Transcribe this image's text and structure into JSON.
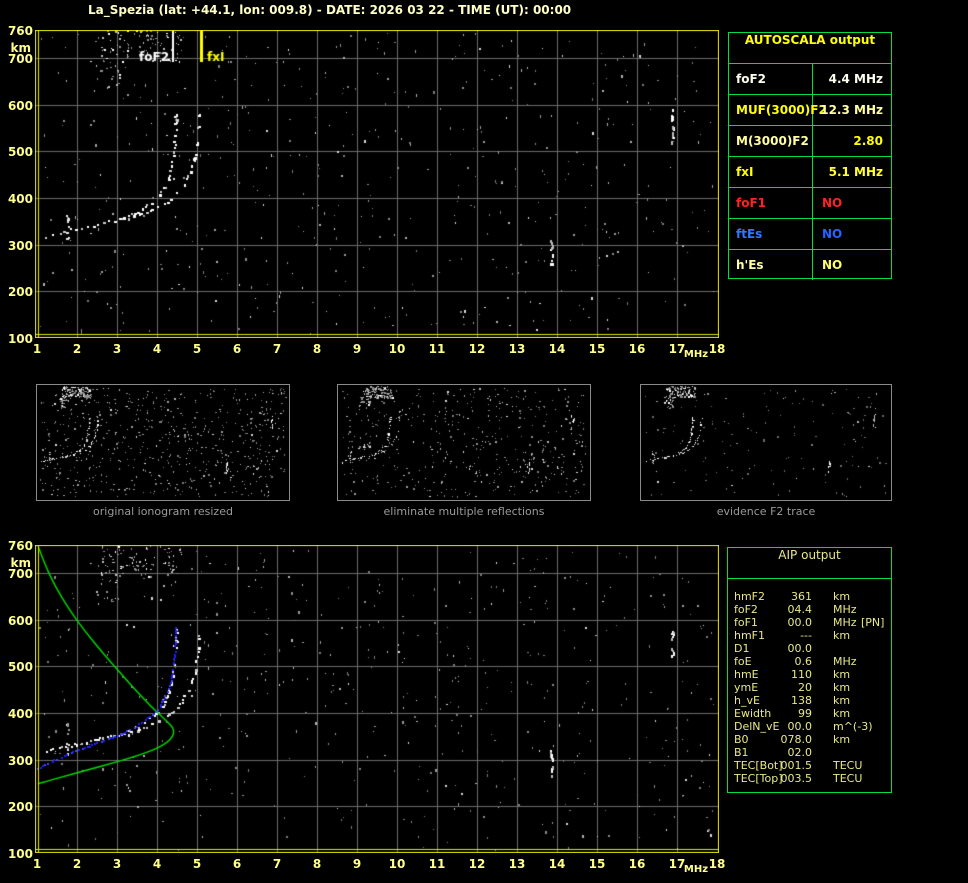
{
  "title": "La_Spezia (lat: +44.1, lon: 009.8) - DATE: 2026 03 22 - TIME (UT): 00:00",
  "colors": {
    "background": "#000000",
    "frame": "#e8e800",
    "grid": "#6b6b6b",
    "tick": "#ffff8c",
    "title": "#ffffc6",
    "table_border": "#00dd44",
    "caption": "#9a9a9a",
    "green_profile": "#00dd00",
    "blue_restored": "#1e1eff",
    "trace_white": "#ffffff",
    "aip_text": "#e8e888"
  },
  "ionogram": {
    "x_ticks": [
      1,
      2,
      3,
      4,
      5,
      6,
      7,
      8,
      9,
      10,
      11,
      12,
      13,
      14,
      15,
      16,
      17,
      18
    ],
    "x_unit": "MHz",
    "y_ticks": [
      760,
      700,
      600,
      500,
      400,
      300,
      200,
      100
    ],
    "y_unit": "km",
    "xlim": [
      1,
      18
    ],
    "ylim": [
      100,
      760
    ],
    "markers": [
      {
        "label": "foF2",
        "freq": 4.4,
        "color": "#ffffff"
      },
      {
        "label": "fxI",
        "freq": 5.1,
        "color": "#ffff00"
      }
    ]
  },
  "chart_data": {
    "type": "scatter",
    "title": "ionogram: virtual height vs frequency",
    "xlabel": "MHz",
    "ylabel": "km",
    "xlim": [
      1,
      18
    ],
    "ylim": [
      100,
      760
    ],
    "o_trace": [
      [
        1.22,
        320
      ],
      [
        1.45,
        325
      ],
      [
        1.7,
        330
      ],
      [
        2.0,
        336
      ],
      [
        2.35,
        342
      ],
      [
        2.7,
        348
      ],
      [
        3.0,
        354
      ],
      [
        3.25,
        362
      ],
      [
        3.5,
        372
      ],
      [
        3.75,
        386
      ],
      [
        3.95,
        400
      ],
      [
        4.1,
        414
      ],
      [
        4.22,
        432
      ],
      [
        4.3,
        452
      ],
      [
        4.36,
        475
      ],
      [
        4.4,
        500
      ],
      [
        4.43,
        528
      ],
      [
        4.45,
        558
      ],
      [
        4.46,
        588
      ]
    ],
    "x_trace": [
      [
        3.3,
        357
      ],
      [
        3.55,
        365
      ],
      [
        3.8,
        374
      ],
      [
        4.05,
        384
      ],
      [
        4.3,
        397
      ],
      [
        4.5,
        415
      ],
      [
        4.65,
        432
      ],
      [
        4.78,
        452
      ],
      [
        4.88,
        472
      ],
      [
        4.95,
        495
      ],
      [
        5.0,
        520
      ],
      [
        5.03,
        550
      ],
      [
        5.05,
        588
      ]
    ],
    "es_spike": {
      "freq": 1.75,
      "h_range": [
        312,
        380
      ],
      "count": 12
    },
    "interference": [
      {
        "freq": 13.85,
        "h_range": [
          256,
          322
        ],
        "count": 10
      },
      {
        "freq": 16.87,
        "h_range": [
          520,
          598
        ],
        "count": 11
      }
    ],
    "noise_clusters": [
      {
        "f_range": [
          2.6,
          4.6
        ],
        "h_range": [
          693,
          760
        ],
        "count": 95
      },
      {
        "f_range": [
          2.45,
          3.05
        ],
        "h_range": [
          632,
          695
        ],
        "count": 18
      }
    ],
    "background_noise_count": 520,
    "green_profile": [
      [
        1.03,
        757
      ],
      [
        1.2,
        718
      ],
      [
        1.45,
        672
      ],
      [
        1.8,
        622
      ],
      [
        2.2,
        575
      ],
      [
        2.65,
        528
      ],
      [
        3.1,
        484
      ],
      [
        3.5,
        446
      ],
      [
        3.85,
        414
      ],
      [
        4.15,
        390
      ],
      [
        4.35,
        374
      ],
      [
        4.43,
        362
      ],
      [
        4.39,
        349
      ],
      [
        4.25,
        336
      ],
      [
        3.95,
        322
      ],
      [
        3.5,
        308
      ],
      [
        2.95,
        294
      ],
      [
        2.35,
        280
      ],
      [
        1.75,
        266
      ],
      [
        1.25,
        254
      ],
      [
        1.02,
        248
      ]
    ],
    "blue_restored": [
      [
        1.02,
        283
      ],
      [
        1.3,
        295
      ],
      [
        1.6,
        307
      ],
      [
        1.95,
        320
      ],
      [
        2.3,
        331
      ],
      [
        2.65,
        342
      ],
      [
        3.0,
        353
      ],
      [
        3.3,
        365
      ],
      [
        3.6,
        380
      ],
      [
        3.85,
        397
      ],
      [
        4.05,
        415
      ],
      [
        4.2,
        437
      ],
      [
        4.3,
        460
      ],
      [
        4.37,
        487
      ],
      [
        4.42,
        517
      ],
      [
        4.45,
        550
      ],
      [
        4.46,
        590
      ]
    ]
  },
  "panels": [
    {
      "caption": "original ionogram resized",
      "noise_count": 620
    },
    {
      "caption": "eliminate multiple reflections",
      "noise_count": 470
    },
    {
      "caption": "evidence F2 trace",
      "noise_count": 150
    }
  ],
  "autoscala": {
    "header": "AUTOSCALA output",
    "rows": [
      {
        "label": "foF2",
        "value": "4.4 MHz",
        "label_color": "#fffff0",
        "value_color": "#fffff0"
      },
      {
        "label": "MUF(3000)F2",
        "value": "12.3 MHz",
        "label_color": "#ffff00",
        "value_color": "#ffffa0"
      },
      {
        "label": "M(3000)F2",
        "value": "2.80",
        "label_color": "#ffffa0",
        "value_color": "#ffff00"
      },
      {
        "label": "fxI",
        "value": "5.1 MHz",
        "label_color": "#ffff00",
        "value_color": "#ffff33"
      },
      {
        "label": "foF1",
        "value": "NO",
        "label_color": "#ff2222",
        "value_color": "#ff2222"
      },
      {
        "label": "ftEs",
        "value": "NO",
        "label_color": "#3377ff",
        "value_color": "#2266ff"
      },
      {
        "label": "h'Es",
        "value": "NO",
        "label_color": "#ffffa0",
        "value_color": "#ffff66"
      }
    ]
  },
  "aip": {
    "header": "AIP output",
    "rows": [
      {
        "label": "hmF2",
        "value": "361",
        "unit": "km",
        "extra": ""
      },
      {
        "label": "foF2",
        "value": "04.4",
        "unit": "MHz",
        "extra": ""
      },
      {
        "label": "foF1",
        "value": "00.0",
        "unit": "MHz",
        "extra": "[PN]"
      },
      {
        "label": "hmF1",
        "value": "---",
        "unit": "km",
        "extra": ""
      },
      {
        "label": "D1",
        "value": "00.0",
        "unit": "",
        "extra": ""
      },
      {
        "label": "foE",
        "value": "0.6",
        "unit": "MHz",
        "extra": ""
      },
      {
        "label": "hmE",
        "value": "110",
        "unit": "km",
        "extra": ""
      },
      {
        "label": "ymE",
        "value": "20",
        "unit": "km",
        "extra": ""
      },
      {
        "label": "h_vE",
        "value": "138",
        "unit": "km",
        "extra": ""
      },
      {
        "label": "Ewidth",
        "value": "99",
        "unit": "km",
        "extra": ""
      },
      {
        "label": "DelN_vE",
        "value": "00.0",
        "unit": "m^(-3)",
        "extra": ""
      },
      {
        "label": "B0",
        "value": "078.0",
        "unit": "km",
        "extra": ""
      },
      {
        "label": "B1",
        "value": "02.0",
        "unit": "",
        "extra": ""
      },
      {
        "label": "TEC[Bot]",
        "value": "001.5",
        "unit": "TECU",
        "extra": ""
      },
      {
        "label": "TEC[Top]",
        "value": "003.5",
        "unit": "TECU",
        "extra": ""
      }
    ]
  }
}
